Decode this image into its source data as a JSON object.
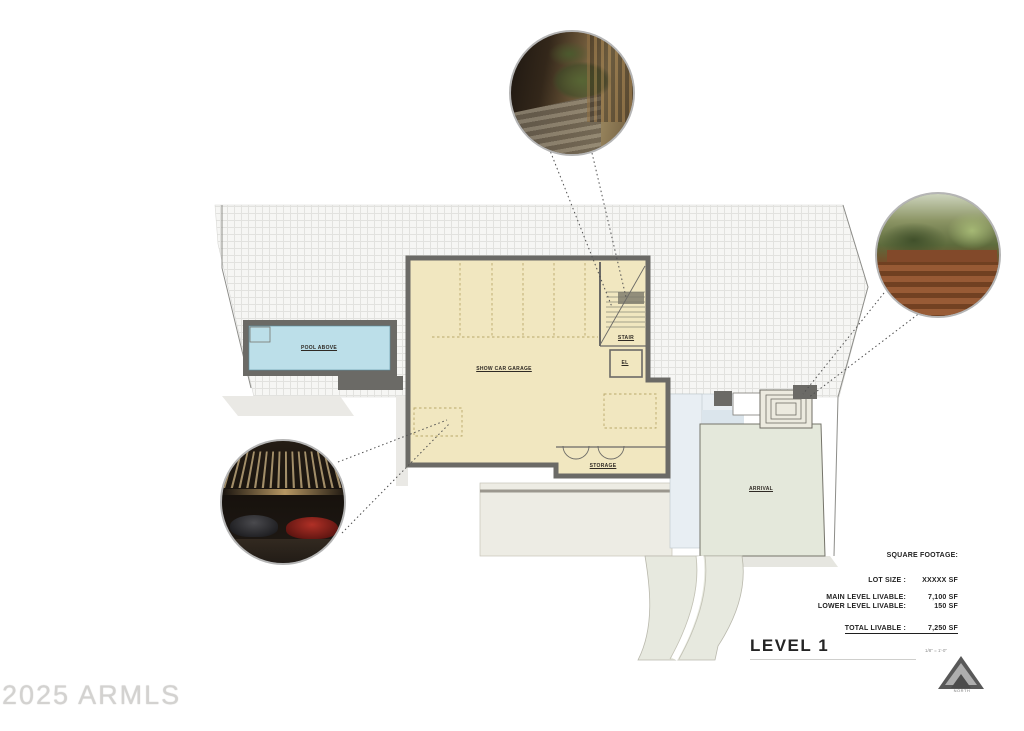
{
  "plan": {
    "level_title": "LEVEL 1",
    "scale_note": "1/8\" = 1'-0\"",
    "north_label": "NORTH",
    "rooms": {
      "pool": "POOL ABOVE",
      "garage": "SHOW CAR GARAGE",
      "stair": "STAIR",
      "elevator": "EL",
      "storage": "STORAGE",
      "arrival": "ARRIVAL"
    }
  },
  "square_footage": {
    "heading": "SQUARE FOOTAGE:",
    "rows": [
      {
        "label": "LOT SIZE :",
        "value": "XXXXX SF"
      },
      {
        "label": "MAIN LEVEL LIVABLE:",
        "value": "7,100 SF"
      },
      {
        "label": "LOWER LEVEL LIVABLE:",
        "value": "150 SF"
      }
    ],
    "total": {
      "label": "TOTAL LIVABLE :",
      "value": "7,250 SF"
    }
  },
  "watermark": "2025 ARMLS",
  "colors": {
    "garage_fill": "#f1e7c0",
    "pool_fill": "#bcdfe9",
    "arrival_fill": "#e4e8db",
    "walk_fill": "#e8eef3",
    "wall": "#6b6a66",
    "hatch_line": "#e0e0dd"
  }
}
